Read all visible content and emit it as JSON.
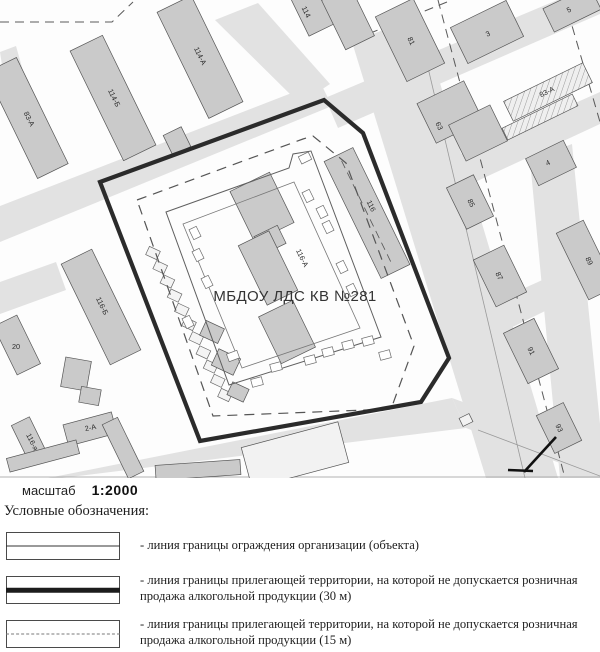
{
  "map": {
    "center_label": {
      "text": "МБДОУ ЛДС КВ №281",
      "x": 295,
      "y": 301
    },
    "colors": {
      "road": "#e2e2e2",
      "building": "#cacaca",
      "building_light": "#f2f2f2",
      "building_stroke": "#555555",
      "thick_boundary": "#2b2b2b",
      "dashed_boundary": "#555555",
      "fence": "#777777"
    },
    "roads": [
      [
        [
          0,
          206
        ],
        [
          320,
          82
        ],
        [
          332,
          106
        ],
        [
          0,
          242
        ]
      ],
      [
        [
          215,
          20
        ],
        [
          258,
          3
        ],
        [
          330,
          84
        ],
        [
          300,
          104
        ]
      ],
      [
        [
          352,
          42
        ],
        [
          420,
          16
        ],
        [
          558,
          478
        ],
        [
          486,
          478
        ]
      ],
      [
        [
          325,
          98
        ],
        [
          600,
          -18
        ],
        [
          600,
          14
        ],
        [
          338,
          128
        ]
      ],
      [
        [
          420,
          172
        ],
        [
          600,
          92
        ],
        [
          600,
          124
        ],
        [
          432,
          202
        ]
      ],
      [
        [
          458,
          318
        ],
        [
          600,
          254
        ],
        [
          600,
          284
        ],
        [
          470,
          348
        ]
      ],
      [
        [
          530,
          160
        ],
        [
          572,
          144
        ],
        [
          600,
          424
        ],
        [
          600,
          478
        ],
        [
          560,
          478
        ]
      ],
      [
        [
          48,
          478
        ],
        [
          452,
          398
        ],
        [
          466,
          428
        ],
        [
          62,
          478
        ]
      ],
      [
        [
          452,
          398
        ],
        [
          600,
          452
        ],
        [
          600,
          478
        ],
        [
          466,
          428
        ]
      ],
      [
        [
          0,
          282
        ],
        [
          56,
          262
        ],
        [
          66,
          290
        ],
        [
          0,
          314
        ]
      ],
      [
        [
          0,
          52
        ],
        [
          16,
          46
        ],
        [
          34,
          110
        ],
        [
          10,
          118
        ]
      ]
    ],
    "buildings": [
      {
        "x": 27,
        "y": 118,
        "w": 118,
        "h": 34,
        "r": 64
      },
      {
        "x": 113,
        "y": 98,
        "w": 122,
        "h": 36,
        "r": 64
      },
      {
        "x": 200,
        "y": 57,
        "w": 118,
        "h": 38,
        "r": 64
      },
      {
        "x": 312,
        "y": 8,
        "w": 48,
        "h": 30,
        "r": 64
      },
      {
        "x": 348,
        "y": 18,
        "w": 55,
        "h": 32,
        "r": 64
      },
      {
        "x": 410,
        "y": 40,
        "w": 72,
        "h": 42,
        "r": 64
      },
      {
        "x": 487,
        "y": 32,
        "w": 62,
        "h": 40,
        "r": -26
      },
      {
        "x": 572,
        "y": 9,
        "w": 52,
        "h": 26,
        "r": -26
      },
      {
        "x": 548,
        "y": 92,
        "w": 88,
        "h": 22,
        "r": -26,
        "hatch": true
      },
      {
        "x": 540,
        "y": 117,
        "w": 78,
        "h": 13,
        "r": -26,
        "hatch": true
      },
      {
        "x": 450,
        "y": 112,
        "w": 52,
        "h": 44,
        "r": -26
      },
      {
        "x": 478,
        "y": 133,
        "w": 46,
        "h": 40,
        "r": -26
      },
      {
        "x": 551,
        "y": 163,
        "w": 42,
        "h": 30,
        "r": -26
      },
      {
        "x": 470,
        "y": 202,
        "w": 46,
        "h": 30,
        "r": 64
      },
      {
        "x": 500,
        "y": 276,
        "w": 52,
        "h": 34,
        "r": 64
      },
      {
        "x": 586,
        "y": 260,
        "w": 74,
        "h": 30,
        "r": 64
      },
      {
        "x": 531,
        "y": 351,
        "w": 56,
        "h": 34,
        "r": 64
      },
      {
        "x": 559,
        "y": 428,
        "w": 42,
        "h": 30,
        "r": 64
      },
      {
        "x": 367,
        "y": 213,
        "w": 130,
        "h": 32,
        "r": 64,
        "dashline": true
      },
      {
        "x": 101,
        "y": 307,
        "w": 112,
        "h": 34,
        "r": 64
      },
      {
        "x": 17,
        "y": 345,
        "w": 54,
        "h": 26,
        "r": 64
      },
      {
        "x": 90,
        "y": 429,
        "w": 50,
        "h": 22,
        "r": -15
      },
      {
        "x": 30,
        "y": 441,
        "w": 44,
        "h": 20,
        "r": 64
      },
      {
        "x": 76,
        "y": 374,
        "w": 26,
        "h": 30,
        "r": 10
      },
      {
        "x": 90,
        "y": 396,
        "w": 20,
        "h": 16,
        "r": 10
      },
      {
        "x": 212,
        "y": 332,
        "w": 20,
        "h": 16,
        "r": 25
      },
      {
        "x": 226,
        "y": 362,
        "w": 24,
        "h": 18,
        "r": 25
      },
      {
        "x": 238,
        "y": 392,
        "w": 18,
        "h": 14,
        "r": 25
      },
      {
        "x": 177,
        "y": 141,
        "w": 22,
        "h": 20,
        "r": 64
      },
      {
        "x": 43,
        "y": 456,
        "w": 72,
        "h": 14,
        "r": -15
      },
      {
        "x": 123,
        "y": 448,
        "w": 60,
        "h": 17,
        "r": 64
      },
      {
        "x": 198,
        "y": 470,
        "w": 85,
        "h": 15,
        "r": -4
      },
      {
        "x": 295,
        "y": 455,
        "w": 100,
        "h": 42,
        "r": -15,
        "white": true
      },
      {
        "x": 466,
        "y": 420,
        "w": 11,
        "h": 9,
        "r": -26,
        "white": true
      },
      {
        "x": 262,
        "y": 207,
        "w": 56,
        "h": 44,
        "r": 64
      },
      {
        "x": 270,
        "y": 240,
        "w": 20,
        "h": 26,
        "r": 64
      },
      {
        "x": 268,
        "y": 268,
        "w": 66,
        "h": 34,
        "r": 64
      },
      {
        "x": 287,
        "y": 332,
        "w": 52,
        "h": 38,
        "r": 64
      }
    ],
    "building_labels": [
      {
        "t": "83-А",
        "x": 27,
        "y": 120,
        "r": 64
      },
      {
        "t": "114-Б",
        "x": 112,
        "y": 99,
        "r": 64
      },
      {
        "t": "114-А",
        "x": 198,
        "y": 57,
        "r": 64
      },
      {
        "t": "114",
        "x": 304,
        "y": 13,
        "r": 64
      },
      {
        "t": "81",
        "x": 409,
        "y": 42,
        "r": 64
      },
      {
        "t": "3",
        "x": 489,
        "y": 36,
        "r": -26
      },
      {
        "t": "5",
        "x": 570,
        "y": 12,
        "r": -26
      },
      {
        "t": "83-А",
        "x": 548,
        "y": 94,
        "r": -26
      },
      {
        "t": "63",
        "x": 437,
        "y": 127,
        "r": 64
      },
      {
        "t": "4",
        "x": 549,
        "y": 165,
        "r": -26
      },
      {
        "t": "85",
        "x": 469,
        "y": 204,
        "r": 64
      },
      {
        "t": "87",
        "x": 497,
        "y": 277,
        "r": 64
      },
      {
        "t": "89",
        "x": 587,
        "y": 262,
        "r": 64
      },
      {
        "t": "91",
        "x": 529,
        "y": 352,
        "r": 64
      },
      {
        "t": "93",
        "x": 557,
        "y": 429,
        "r": 64
      },
      {
        "t": "116",
        "x": 369,
        "y": 207,
        "r": 64
      },
      {
        "t": "116-А",
        "x": 300,
        "y": 259,
        "r": 64
      },
      {
        "t": "116-Б",
        "x": 100,
        "y": 307,
        "r": 64
      },
      {
        "t": "20",
        "x": 16,
        "y": 349,
        "r": 0
      },
      {
        "t": "2-А",
        "x": 91,
        "y": 430,
        "r": -12
      },
      {
        "t": "116-я",
        "x": 30,
        "y": 443,
        "r": 64
      }
    ],
    "boundaries": {
      "thick": [
        [
          100,
          182
        ],
        [
          324,
          100
        ],
        [
          363,
          133
        ],
        [
          449,
          358
        ],
        [
          421,
          402
        ],
        [
          200,
          441
        ]
      ],
      "dashed15": [
        [
          137,
          200
        ],
        [
          303,
          139
        ],
        [
          313,
          136
        ],
        [
          346,
          163
        ],
        [
          414,
          346
        ],
        [
          391,
          409
        ],
        [
          213,
          416
        ]
      ],
      "fence": [
        [
          166,
          212
        ],
        [
          289,
          168
        ],
        [
          293,
          154
        ],
        [
          311,
          151
        ],
        [
          381,
          337
        ],
        [
          229,
          385
        ]
      ],
      "fence_inner": [
        [
          183,
          224
        ],
        [
          294,
          182
        ],
        [
          360,
          328
        ],
        [
          242,
          368
        ]
      ]
    },
    "play_squares": [
      [
        195,
        233,
        64
      ],
      [
        198,
        255,
        64
      ],
      [
        207,
        282,
        64
      ],
      [
        188,
        322,
        64
      ],
      [
        233,
        356,
        -20
      ],
      [
        257,
        382,
        -15
      ],
      [
        276,
        367,
        -15
      ],
      [
        310,
        360,
        -15
      ],
      [
        328,
        352,
        -15
      ],
      [
        348,
        345,
        -15
      ],
      [
        368,
        341,
        -15
      ],
      [
        385,
        355,
        -15
      ],
      [
        322,
        212,
        64
      ],
      [
        328,
        227,
        64
      ],
      [
        342,
        267,
        64
      ],
      [
        352,
        290,
        64
      ],
      [
        305,
        158,
        -26
      ],
      [
        308,
        196,
        64
      ]
    ],
    "garages": {
      "x": 153,
      "y": 253,
      "dx": 7.2,
      "dy": 14.2,
      "n": 11,
      "w": 12,
      "h": 9,
      "r": 25
    },
    "street_dashed": [
      [
        [
          0,
          22
        ],
        [
          112,
          22
        ],
        [
          133,
          2
        ]
      ],
      [
        [
          447,
          2
        ],
        [
          373,
          32
        ]
      ],
      [
        [
          438,
          0
        ],
        [
          565,
          478
        ]
      ],
      [
        [
          568,
          12
        ],
        [
          600,
          122
        ]
      ]
    ],
    "street_lines": [
      [
        [
          412,
          0
        ],
        [
          525,
          478
        ]
      ],
      [
        [
          478,
          430
        ],
        [
          600,
          476
        ]
      ],
      [
        [
          0,
          477
        ],
        [
          600,
          477
        ]
      ]
    ],
    "check_mark": [
      [
        [
          508,
          470
        ],
        [
          533,
          471
        ]
      ],
      [
        [
          524,
          472
        ],
        [
          556,
          437
        ]
      ]
    ]
  },
  "scale": {
    "label": "масштаб",
    "value": "1:2000"
  },
  "legend": {
    "title": "Условные обозначения:",
    "items": [
      {
        "style": "thin",
        "text": "- линия границы ограждения организации (объекта)"
      },
      {
        "style": "thick",
        "text": "- линия границы прилегающей территории, на которой не допускается розничная продажа алкогольной продукции (30 м)"
      },
      {
        "style": "dashed",
        "text": "- линия границы прилегающей территории, на которой не допускается розничная продажа алкогольной продукции (15 м)"
      }
    ]
  }
}
